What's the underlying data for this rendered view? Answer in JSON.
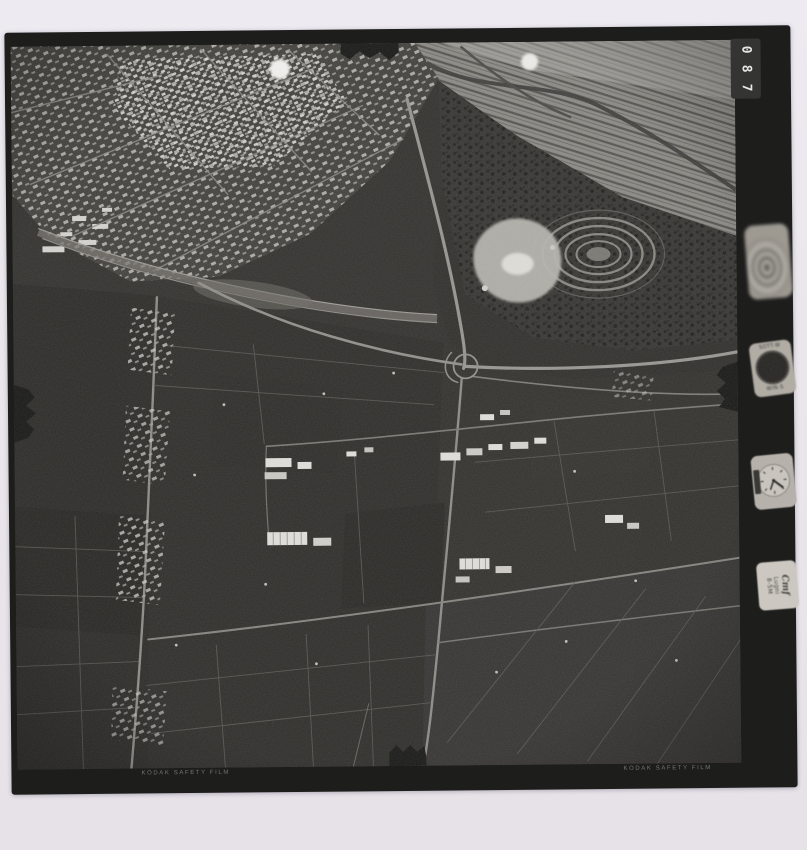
{
  "photo_frame": {
    "counter": {
      "digit_top": "0",
      "digit_middle": "8",
      "digit_bottom": "7"
    },
    "film_edge_text_left": "KODAK SAFETY FILM",
    "film_edge_text_right": "KODAK SAFETY FILM"
  },
  "instruments": {
    "compass_label_top": "SOTT-W",
    "compass_label_bottom": "WIN-S",
    "data_card": {
      "line1": "Cmf",
      "line2": "Lugni",
      "line3": "8-5M"
    }
  },
  "colors": {
    "scan_background": "#e9e5ea",
    "film_rebate_black": "#1d1d1c",
    "photo_base_gray": "#2f2e2b",
    "road_light_gray": "#93918c",
    "building_white": "#dedcd8",
    "counter_digit": "#e7e7e4"
  }
}
